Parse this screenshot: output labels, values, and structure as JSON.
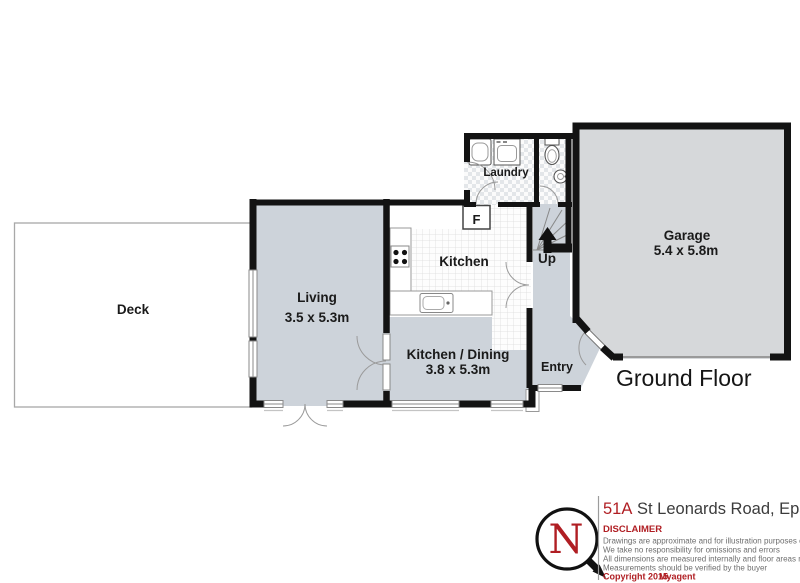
{
  "colors": {
    "wall": "#131313",
    "floor_blue": "#cdd3da",
    "floor_gray": "#d6d8da",
    "accent_red": "#b01e23",
    "label_dark": "#1a1a1a",
    "address_gray": "#3c3c3c",
    "body_gray": "#6e6e6e"
  },
  "floor_plan": {
    "floor_title": "Ground Floor",
    "rooms": {
      "deck": {
        "label": "Deck"
      },
      "living": {
        "label": "Living",
        "dims": "3.5 x 5.3m"
      },
      "kitchen": {
        "label": "Kitchen"
      },
      "kitchen_dining": {
        "label": "Kitchen / Dining",
        "dims": "3.8 x 5.3m"
      },
      "laundry": {
        "label": "Laundry"
      },
      "garage": {
        "label": "Garage",
        "dims": "5.4 x 5.8m"
      },
      "entry": {
        "label": "Entry"
      },
      "stairs": {
        "label": "Up"
      },
      "fridge": {
        "label": "F"
      }
    }
  },
  "title_block": {
    "compass_letter": "N",
    "address_number": "51A",
    "address_street": "St Leonards Road, Epsom",
    "disclaimer_title": "DISCLAIMER",
    "disclaimer_lines": [
      "Drawings are approximate and for illustration purposes only",
      "We take no responsibility for omissions and errors",
      "All dimensions are measured internally and floor areas reflect this",
      "Measurements should be verified by the buyer"
    ],
    "copyright": "Copyright 2015",
    "agency": "Myagent"
  }
}
